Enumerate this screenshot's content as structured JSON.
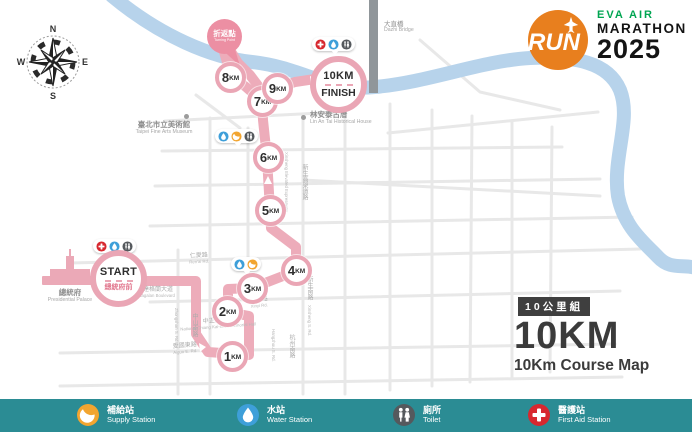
{
  "logo": {
    "run_text": "RUN",
    "brand": "EVA AIR",
    "event": "MARATHON",
    "year": "2025"
  },
  "compass": {
    "n": "N",
    "e": "E",
    "s": "S",
    "w": "W"
  },
  "course_info": {
    "badge": "10公里組",
    "distance": "10KM",
    "subtitle": "10Km Course Map"
  },
  "markers": {
    "start": {
      "label": "START",
      "sublabel": "總統府前"
    },
    "finish": {
      "label": "10KM",
      "sublabel": "FINISH"
    },
    "turnaround": {
      "label": "折返點",
      "sublabel": "Turning Point"
    },
    "km": [
      {
        "num": "1",
        "unit": "KM"
      },
      {
        "num": "2",
        "unit": "KM"
      },
      {
        "num": "3",
        "unit": "KM"
      },
      {
        "num": "4",
        "unit": "KM"
      },
      {
        "num": "5",
        "unit": "KM"
      },
      {
        "num": "6",
        "unit": "KM"
      },
      {
        "num": "7",
        "unit": "KM"
      },
      {
        "num": "8",
        "unit": "KM"
      },
      {
        "num": "9",
        "unit": "KM"
      }
    ]
  },
  "places": {
    "museum": {
      "zh": "臺北市立美術館",
      "en": "Taipei Fine Arts Museum"
    },
    "lin_an_tai": {
      "zh": "林安泰古厝",
      "en": "Lin An Tai Historical House"
    },
    "dazhi_bridge": {
      "zh": "大直橋",
      "en": "Dazhi Bridge"
    },
    "presidential_palace": {
      "zh": "總統府",
      "en": "Presidential Palace"
    }
  },
  "roads": {
    "ketagalan": {
      "zh": "凱達格蘭大道",
      "en": "Ketagalan Boulevard"
    },
    "renai": {
      "zh": "仁愛路",
      "en": "Ren'ai Rd."
    },
    "xinyi": {
      "zh": "信義路",
      "en": "Xinyi Rd."
    },
    "aiguo": {
      "zh": "愛國東路",
      "en": "Aiguo E. Rd."
    },
    "cks_memorial": {
      "zh": "中正紀念堂",
      "en": "National Chiang Kai-shek Memorial Hall"
    },
    "zhongshan": {
      "zh": "中山南路",
      "en": "Zhongshan S. Rd."
    },
    "hangzhou": {
      "zh": "杭州南路",
      "en": "Hangzhou S. Rd."
    },
    "xinsheng_s": {
      "zh": "新生南路",
      "en": "Xinsheng S. Rd."
    },
    "xinsheng_elevated": {
      "zh": "新生高架道路",
      "en": "Xinsheng Elevated Expressway"
    }
  },
  "legend": {
    "items": [
      {
        "zh": "補給站",
        "en": "Supply Station",
        "icon": "supply-icon",
        "color": "#f2a530"
      },
      {
        "zh": "水站",
        "en": "Water Station",
        "icon": "water-icon",
        "color": "#3e9fd9"
      },
      {
        "zh": "廁所",
        "en": "Toilet",
        "icon": "toilet-icon",
        "color": "#55595d"
      },
      {
        "zh": "醫護站",
        "en": "First Aid Station",
        "icon": "first-aid-icon",
        "color": "#d7282f"
      }
    ]
  },
  "station_groups": {
    "start": [
      "first-aid",
      "water",
      "toilet"
    ],
    "finish": [
      "first-aid",
      "water",
      "toilet"
    ],
    "km6": [
      "water",
      "supply",
      "toilet"
    ],
    "km3": [
      "water",
      "supply"
    ]
  },
  "colors": {
    "route_pink": "#edacba",
    "marker_ring": "#eaa6b5",
    "balloon_pink": "#ec8fa3",
    "river_blue": "#b7d3eb",
    "road_gray": "#e8e8e8",
    "bridge_gray": "#90969a",
    "legend_teal": "#2b8c94",
    "logo_orange": "#e87f1e",
    "brand_green": "#00a551",
    "ink": "#3b3b3b"
  }
}
